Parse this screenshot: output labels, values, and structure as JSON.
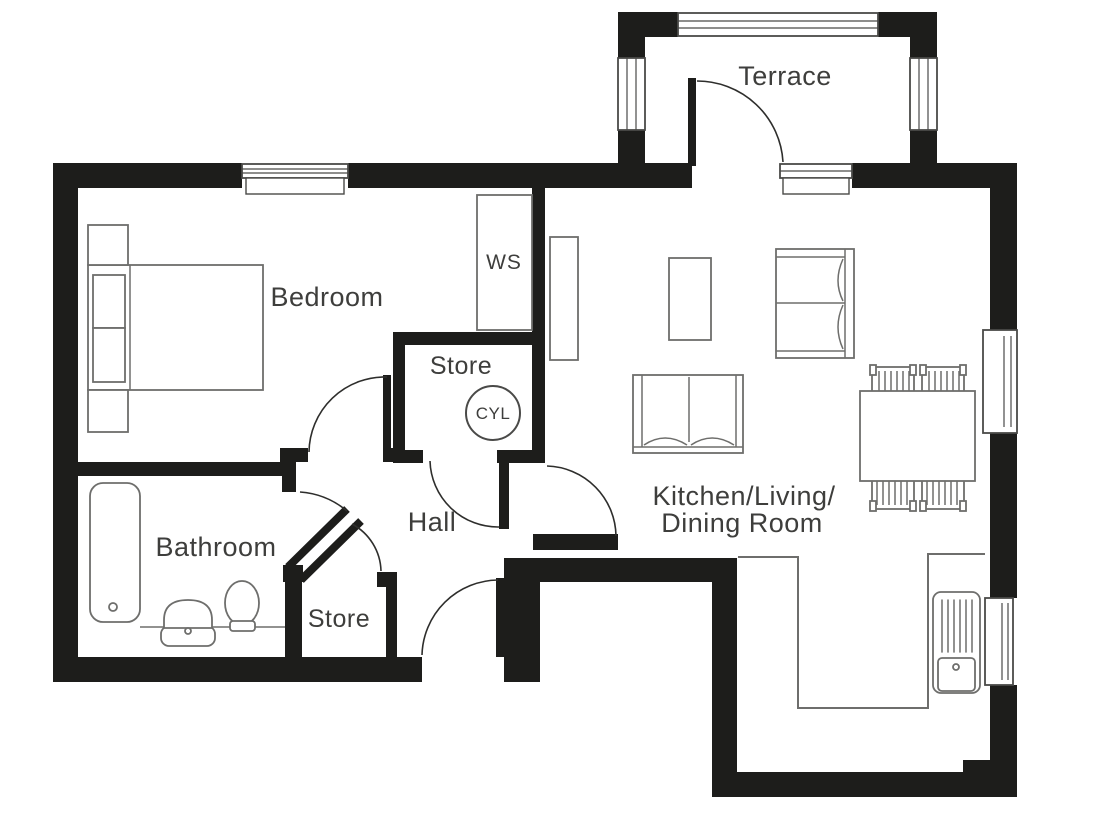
{
  "title": "One-bedroom apartment floor plan",
  "colors": {
    "wall": "#1d1d1b",
    "furniture": "#6e6e6c",
    "text": "#3e3e3c",
    "door": "#2e2e2c",
    "window_frame": "#4a4a48",
    "background": "#ffffff"
  },
  "labels": {
    "terrace": "Terrace",
    "bedroom": "Bedroom",
    "bathroom": "Bathroom",
    "hall": "Hall",
    "store_top": "Store",
    "store_bottom": "Store",
    "kitchen_line1": "Kitchen/Living/",
    "kitchen_line2": "Dining Room",
    "wardrobe": "WS",
    "cylinder": "CYL"
  },
  "fixtures": [
    "double-bed",
    "bedside-table",
    "bedside-table",
    "wardrobe-ws",
    "hot-water-cylinder",
    "bathtub",
    "wash-basin",
    "toilet",
    "tall-cabinet",
    "coffee-table",
    "sofa-two-seat-vertical",
    "sofa-two-seat-horizontal",
    "dining-table",
    "dining-chair",
    "dining-chair",
    "dining-chair",
    "dining-chair",
    "kitchen-counter",
    "kitchen-sink-drainer"
  ],
  "openings": [
    "terrace-door",
    "bedroom-door",
    "store-top-door",
    "bathroom-diagonal-door",
    "store-bottom-opening",
    "kitchen-door",
    "front-door"
  ],
  "windows": [
    "bedroom-window",
    "terrace-railing",
    "terrace-left-window",
    "terrace-right-window",
    "terrace-kitchen-window",
    "right-wall-upper-window",
    "right-wall-lower-window"
  ]
}
